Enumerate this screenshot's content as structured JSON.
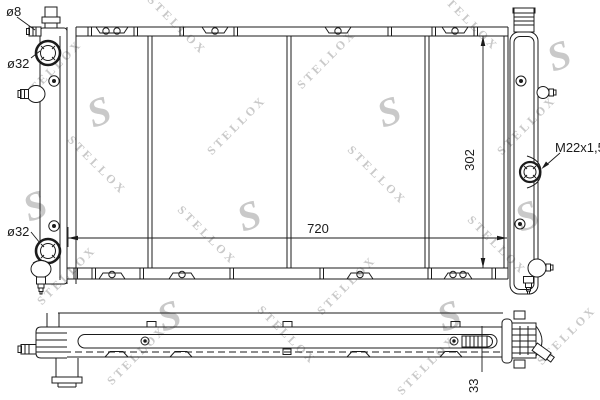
{
  "watermark": {
    "text": "STELLOX",
    "monogram": "S",
    "color": "#c9c9c9"
  },
  "drawing": {
    "background": "#ffffff",
    "line_color": "#1b1b1b",
    "labels": {
      "inlet_diameter": "ø8",
      "upper_port_diameter": "ø32",
      "lower_port_diameter": "ø32",
      "core_width_mm": "720",
      "core_height_mm": "302",
      "thread_spec": "M22x1,5",
      "core_depth_mm": "33"
    }
  }
}
